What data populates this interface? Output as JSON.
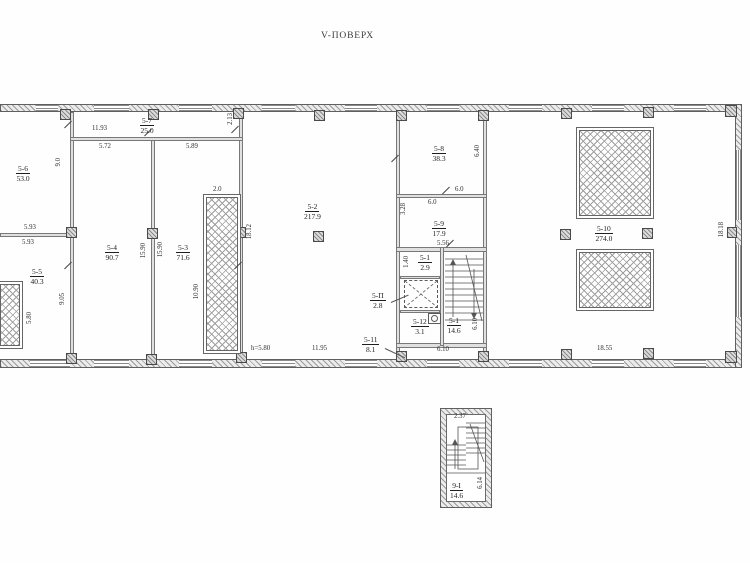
{
  "title": "V-ПОВЕРХ",
  "rooms": {
    "r5_1_up": {
      "number": "5-1",
      "area": "2.9"
    },
    "r5_1": {
      "number": "5-1",
      "area": "14.6"
    },
    "r5_2": {
      "number": "5-2",
      "area": "217.9"
    },
    "r5_3": {
      "number": "5-3",
      "area": "71.6"
    },
    "r5_4": {
      "number": "5-4",
      "area": "90.7"
    },
    "r5_5": {
      "number": "5-5",
      "area": "40.3"
    },
    "r5_6": {
      "number": "5-6",
      "area": "53.0"
    },
    "r5_7": {
      "number": "5-7",
      "area": "25.0"
    },
    "r5_8": {
      "number": "5-8",
      "area": "38.3"
    },
    "r5_9": {
      "number": "5-9",
      "area": "17.9"
    },
    "r5_10": {
      "number": "5-10",
      "area": "274.0"
    },
    "r5_11": {
      "number": "5-11",
      "area": "8.1"
    },
    "r5_12": {
      "number": "5-12",
      "area": "3.1"
    },
    "r5_lift": {
      "number": "5-П",
      "area": "2.8"
    },
    "detail_stair": {
      "number": "9-I",
      "area": "14.6"
    }
  },
  "dims": {
    "top_total": "11.93",
    "top_left": "5.72",
    "top_right": "5.89",
    "depth_5_7": "2.13",
    "height_5_6": "9.0",
    "width_5_6_a": "5.93",
    "width_5_6_b": "5.93",
    "height_5_4": "15.90",
    "height_5_3": "15.90",
    "shaft_width": "2.0",
    "height_mid": "18.12",
    "shaft_height": "10.90",
    "height_5_5": "9.05",
    "height_shaft_left": "5.80",
    "ceiling_height": "h=5.80",
    "width_5_2": "11.95",
    "height_5_8": "6.40",
    "width_5_8_a": "6.0",
    "width_5_8_b": "6.0",
    "height_5_9_left": "3.28",
    "width_5_9": "5.56",
    "height_5_1_small": "1.40",
    "height_stairs": "6.10",
    "width_stairs": "6.10",
    "width_5_10": "18.55",
    "height_5_10": "18.18",
    "detail_width": "2.37",
    "detail_height": "6.14"
  },
  "colors": {
    "line": "#5f5f5f",
    "hatch": "#9b9b9b",
    "text": "#2e2e2e"
  }
}
